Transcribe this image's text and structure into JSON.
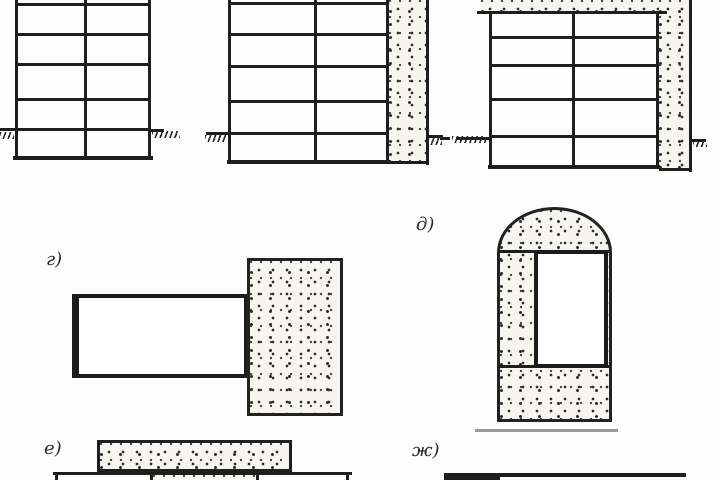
{
  "figure": {
    "labels": {
      "g": "г)",
      "d": "д)",
      "e": "е)",
      "zh": "ж)"
    },
    "colors": {
      "line": "#1e1e1e",
      "stipple_base": "#f7f5f0",
      "background": "#fdfdfd",
      "shadow_line": "#9b9b9b"
    }
  }
}
